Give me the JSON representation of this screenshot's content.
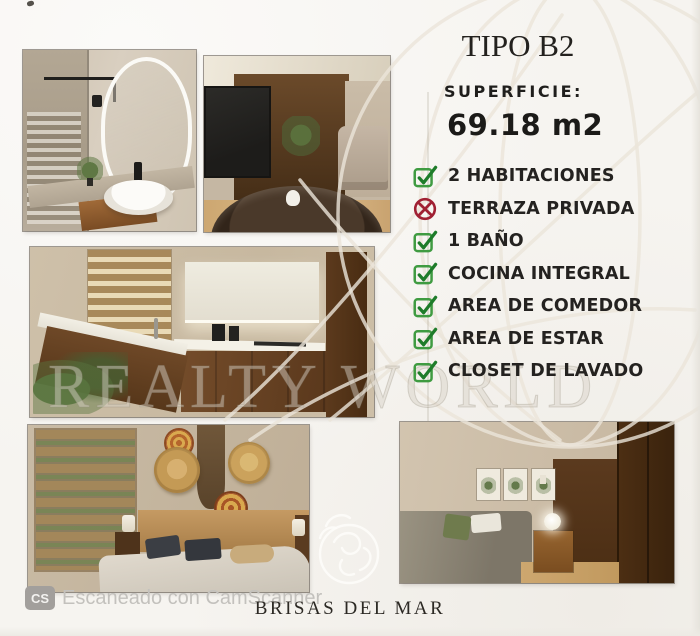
{
  "document": {
    "unit_type_title": "TIPO B2",
    "surface_label": "SUPERFICIE:",
    "surface_value": "69.18 m2",
    "project_name": "BRISAS DEL MAR"
  },
  "checklist": {
    "items": [
      {
        "label": "2 HABITACIONES",
        "included": true
      },
      {
        "label": "TERRAZA PRIVADA",
        "included": false
      },
      {
        "label": "1 BAÑO",
        "included": true
      },
      {
        "label": "COCINA INTEGRAL",
        "included": true
      },
      {
        "label": "AREA DE COMEDOR",
        "included": true
      },
      {
        "label": "AREA DE ESTAR",
        "included": true
      },
      {
        "label": "CLOSET DE LAVADO",
        "included": true
      }
    ]
  },
  "watermark": {
    "brand_text": "REALTY WORLD"
  },
  "scanner_footer": {
    "badge": "CS",
    "text": "Escaneado con CamScanner"
  },
  "photos": [
    {
      "name": "bathroom-render"
    },
    {
      "name": "tv-lounge-render"
    },
    {
      "name": "kitchen-render"
    },
    {
      "name": "main-bedroom-render"
    },
    {
      "name": "second-bedroom-render"
    }
  ],
  "colors": {
    "check_green": "#3f9b41",
    "check_mark_green": "#1e7c2a",
    "cross_red": "#a02033",
    "text_dark": "#22201d",
    "scanner_gray": "#c3c1bd"
  }
}
